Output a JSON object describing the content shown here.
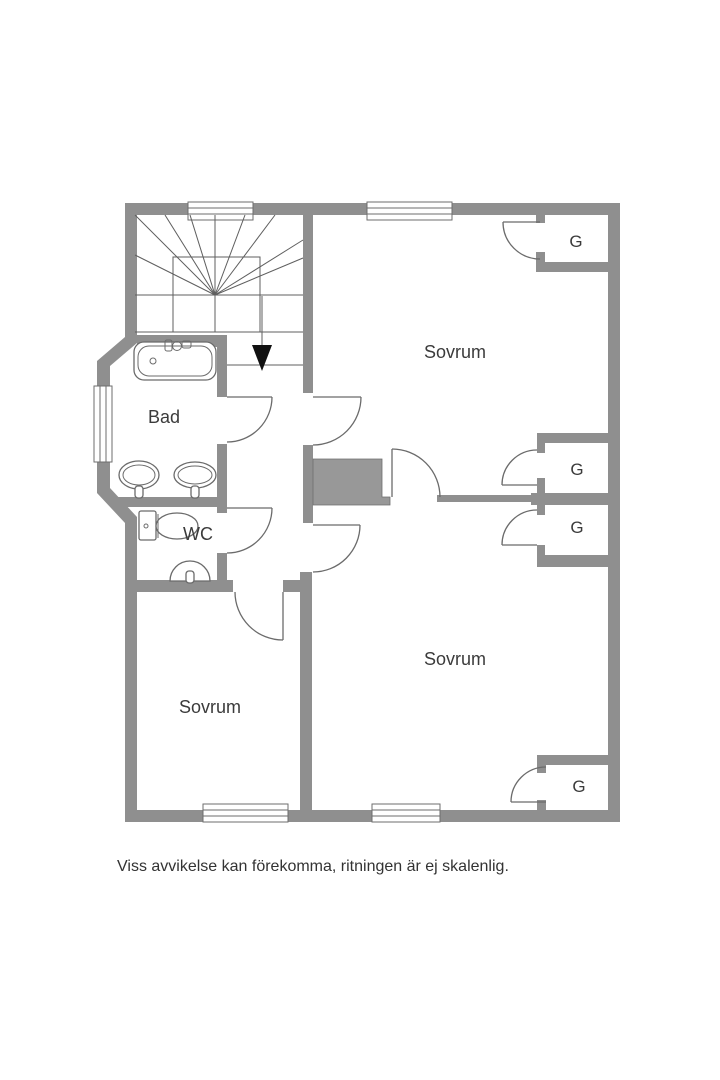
{
  "floorplan": {
    "disclaimer": "Viss avvikelse kan förekomma, ritningen är ej skalenlig.",
    "colors": {
      "background": "#ffffff",
      "wall": "#8f8f8f",
      "shaft_fill": "#989898",
      "thin_line": "#5f5f5f",
      "door_line": "#6b6b6b",
      "text": "#3b3b3b",
      "arrow": "#111111"
    },
    "rooms": {
      "bedroom_top_right": {
        "label": "Sovrum"
      },
      "bedroom_bottom_right": {
        "label": "Sovrum"
      },
      "bedroom_bottom_left": {
        "label": "Sovrum"
      },
      "bathroom": {
        "label": "Bad"
      },
      "toilet": {
        "label": "WC"
      }
    },
    "closets": {
      "top_right": {
        "label": "G"
      },
      "middle_upper": {
        "label": "G"
      },
      "middle_lower": {
        "label": "G"
      },
      "bottom_right": {
        "label": "G"
      }
    }
  }
}
